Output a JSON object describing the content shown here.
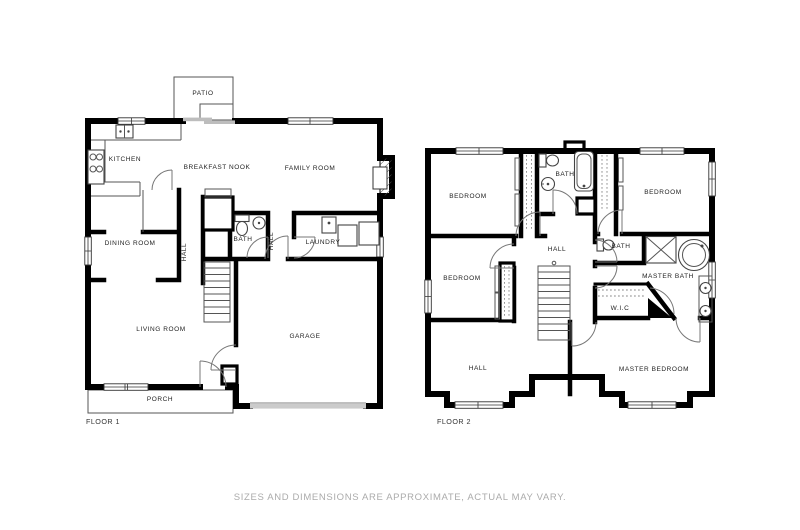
{
  "page": {
    "background": "#ffffff"
  },
  "floor1": {
    "label": "FLOOR 1",
    "rooms": {
      "patio": "PATIO",
      "kitchen": "KITCHEN",
      "breakfast_nook": "BREAKFAST NOOK",
      "family_room": "FAMILY ROOM",
      "dining_room": "DINING ROOM",
      "hall_left": "HALL",
      "bath": "BATH",
      "hall_right": "HALL",
      "laundry": "LAUNDRY",
      "living_room": "LIVING ROOM",
      "garage": "GARAGE",
      "porch": "PORCH"
    }
  },
  "floor2": {
    "label": "FLOOR 2",
    "rooms": {
      "bedroom_top_left": "BEDROOM",
      "bath_top": "BATH",
      "bedroom_top_right": "BEDROOM",
      "hall_upper": "HALL",
      "bedroom_mid_left": "BEDROOM",
      "bath_small": "BATH",
      "master_bath": "MASTER BATH",
      "wic": "W.I.C",
      "hall_lower": "HALL",
      "master_bedroom": "MASTER BEDROOM"
    }
  },
  "footer": {
    "disclaimer": "SIZES AND DIMENSIONS ARE APPROXIMATE, ACTUAL MAY VARY."
  },
  "colors": {
    "wall": "#000000",
    "label_text": "#222222",
    "caption_text": "#ababab",
    "sliding_door": "#bdbdbd",
    "garage_door": "#cbcbcb"
  }
}
